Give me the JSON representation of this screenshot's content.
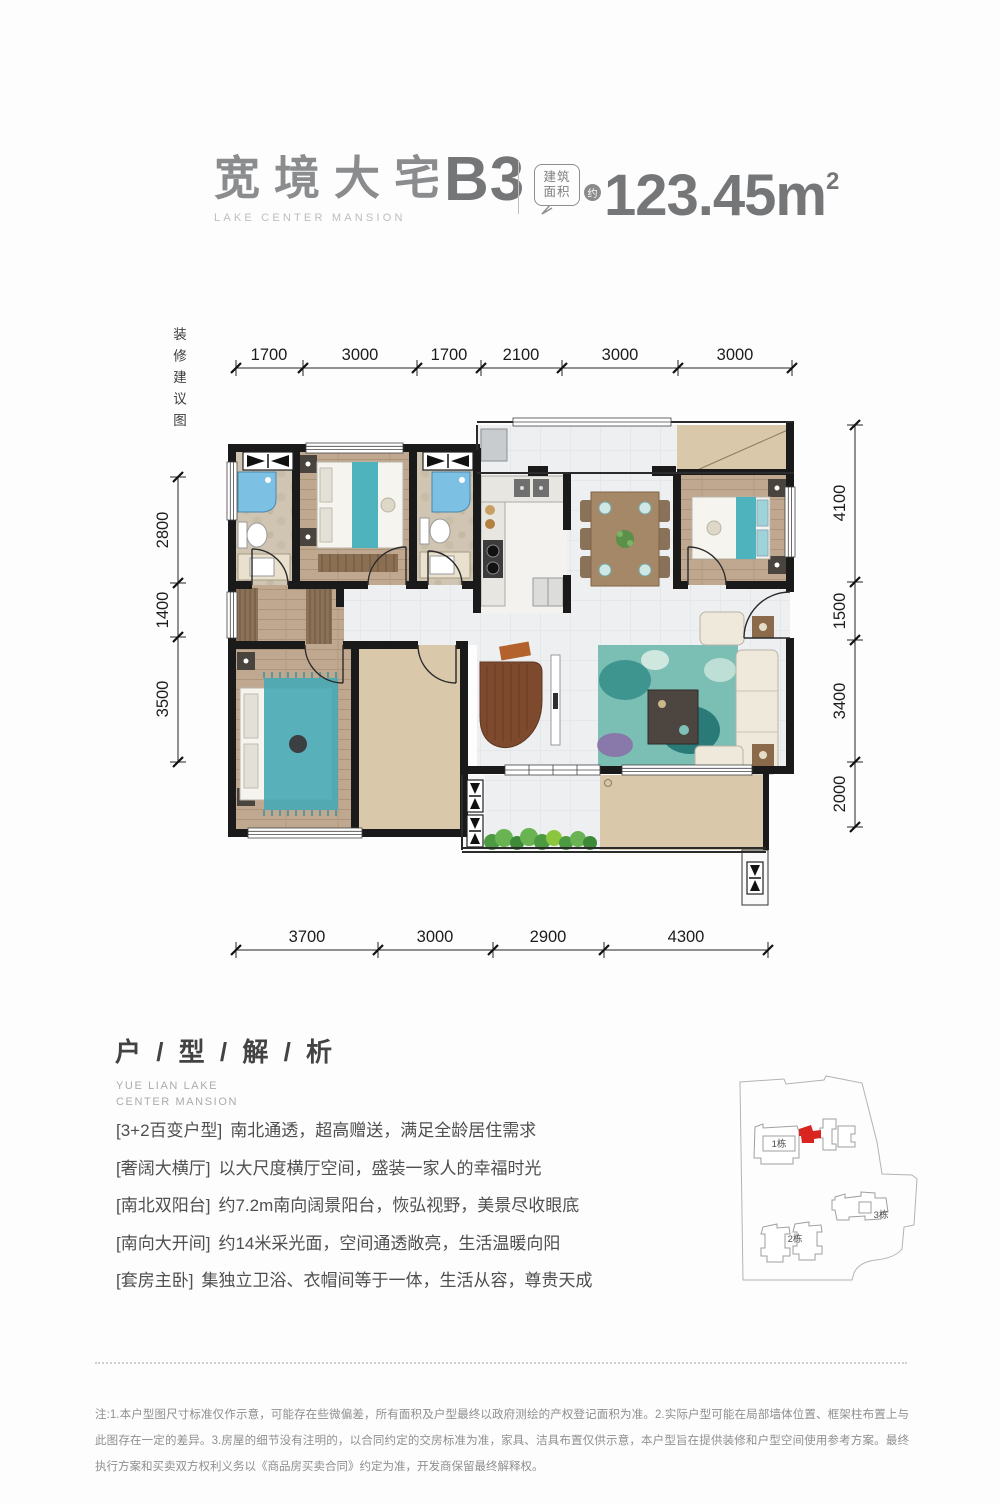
{
  "header": {
    "title": "宽境大宅",
    "subtitle": "LAKE CENTER MANSION",
    "unit": "B3",
    "area_label_line1": "建筑",
    "area_label_line2": "面积",
    "area_approx": "约",
    "area_value": "123.45m",
    "area_exponent": "2"
  },
  "plan": {
    "side_note": "装修建议图",
    "dims": {
      "top": [
        "1700",
        "3000",
        "1700",
        "2100",
        "3000",
        "3000"
      ],
      "bottom": [
        "3700",
        "3000",
        "2900",
        "4300"
      ],
      "left": [
        "2800",
        "1400",
        "3500"
      ],
      "right": [
        "4100",
        "1500",
        "3400",
        "2000"
      ]
    }
  },
  "analysis": {
    "title": "户 / 型 / 解 / 析",
    "subtitle_line1": "YUE LIAN LAKE",
    "subtitle_line2": "CENTER MANSION",
    "features": [
      {
        "tag": "[3+2百变户型]",
        "text": "南北通透，超高赠送，满足全龄居住需求"
      },
      {
        "tag": "[奢阔大横厅]",
        "text": "以大尺度横厅空间，盛装一家人的幸福时光"
      },
      {
        "tag": "[南北双阳台]",
        "text": "约7.2m南向阔景阳台，恢弘视野，美景尽收眼底"
      },
      {
        "tag": "[南向大开间]",
        "text": "约14米采光面，空间通透敞亮，生活温暖向阳"
      },
      {
        "tag": "[套房主卧]",
        "text": "集独立卫浴、衣帽间等于一体，生活从容，尊贵天成"
      }
    ]
  },
  "sitemap": {
    "building1": "1栋",
    "building2": "2栋",
    "building3": "3栋",
    "highlight_color": "#d8251f"
  },
  "footer": {
    "disclaimer": "注:1.本户型图尺寸标准仅作示意，可能存在些微偏差，所有面积及户型最终以政府测绘的产权登记面积为准。2.实际户型可能在局部墙体位置、框架柱布置上与此图存在一定的差异。3.房屋的细节没有注明的，以合同约定的交房标准为准，家具、洁具布置仅供示意，本户型旨在提供装修和户型空间使用参考方案。最终执行方案和买卖双方权利义务以《商品房买卖合同》约定为准，开发商保留最终解释权。"
  },
  "colors": {
    "accent_red": "#d8251f",
    "teal": "#4fb3bd",
    "wood": "#bfa88f",
    "beige": "#d9c8a9"
  }
}
